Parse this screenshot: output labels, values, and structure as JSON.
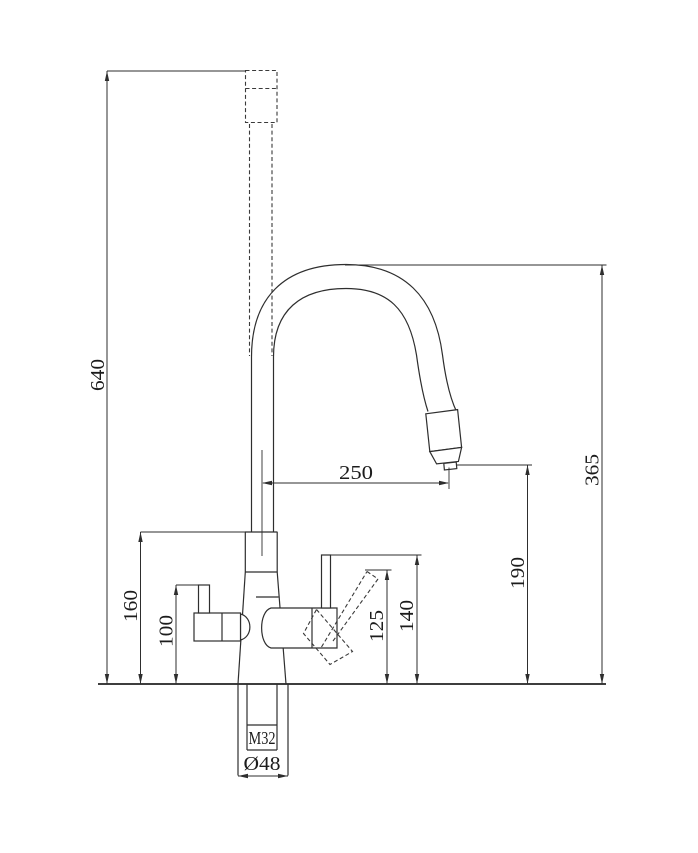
{
  "drawing": {
    "dims": {
      "d640": {
        "label": "640"
      },
      "d365": {
        "label": "365"
      },
      "d250": {
        "label": "250"
      },
      "d190": {
        "label": "190"
      },
      "d160": {
        "label": "160"
      },
      "d100": {
        "label": "100"
      },
      "d125": {
        "label": "125"
      },
      "d140": {
        "label": "140"
      },
      "thread": {
        "label": "M32"
      },
      "diameter": {
        "label": "Ø48"
      }
    },
    "line_color": "#2e2e2e",
    "background_color": "#ffffff"
  }
}
